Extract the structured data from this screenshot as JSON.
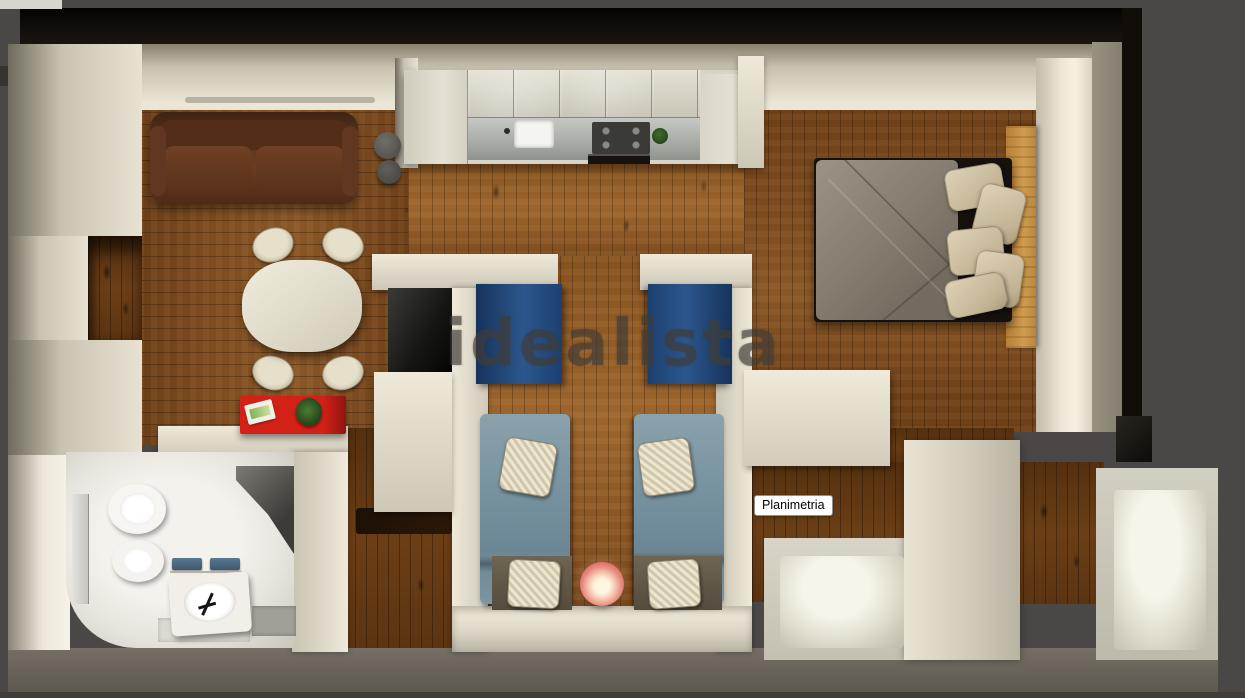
{
  "watermark": {
    "text": "idealista"
  },
  "tooltip": {
    "label": "Planimetria"
  },
  "palette": {
    "background": "#4b4747",
    "outer_wall_dark": "#0b0806",
    "wall_cream": "#e6e0d0",
    "floor_wood": "#7a4a1e",
    "floor_wood_light": "#9a6228",
    "sofa_brown": "#5a3220",
    "sideboard_red": "#c71f17",
    "double_bed_headboard_wood": "#c89045",
    "twin_headboard_blue": "#2a4e7e",
    "twin_blanket_blue": "#76909f",
    "lamp_coral": "#e7857a",
    "towel_blue": "#49637a"
  },
  "scene": {
    "type": "3d-floorplan-top-view",
    "rooms": [
      "living-dining",
      "kitchen",
      "double-bedroom",
      "twin-bedroom",
      "bathroom",
      "hallway"
    ]
  }
}
